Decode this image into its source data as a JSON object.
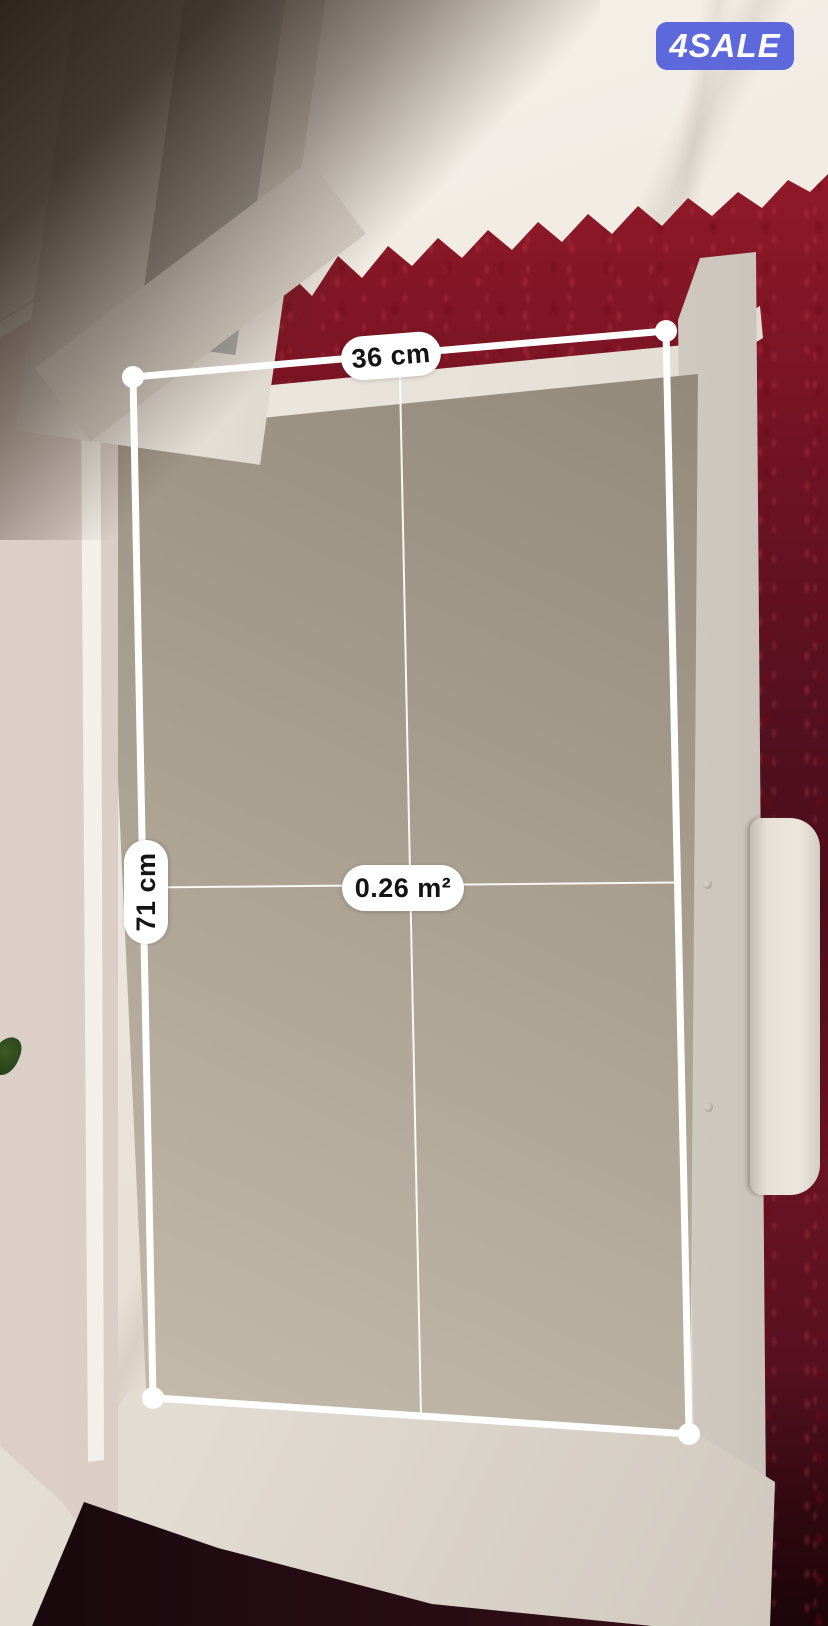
{
  "badge": {
    "label": "4SALE",
    "background_color": "#5e68dd",
    "text_color": "#ffffff"
  },
  "ar_measure": {
    "width_label": "36 cm",
    "height_label": "71 cm",
    "area_label": "0.26 m²",
    "line_color": "#ffffff",
    "label_background": "#ffffff",
    "label_text_color": "#141414"
  },
  "scene": {
    "carpet_color": "#7c1322",
    "furniture_color": "#e7e1d9"
  }
}
